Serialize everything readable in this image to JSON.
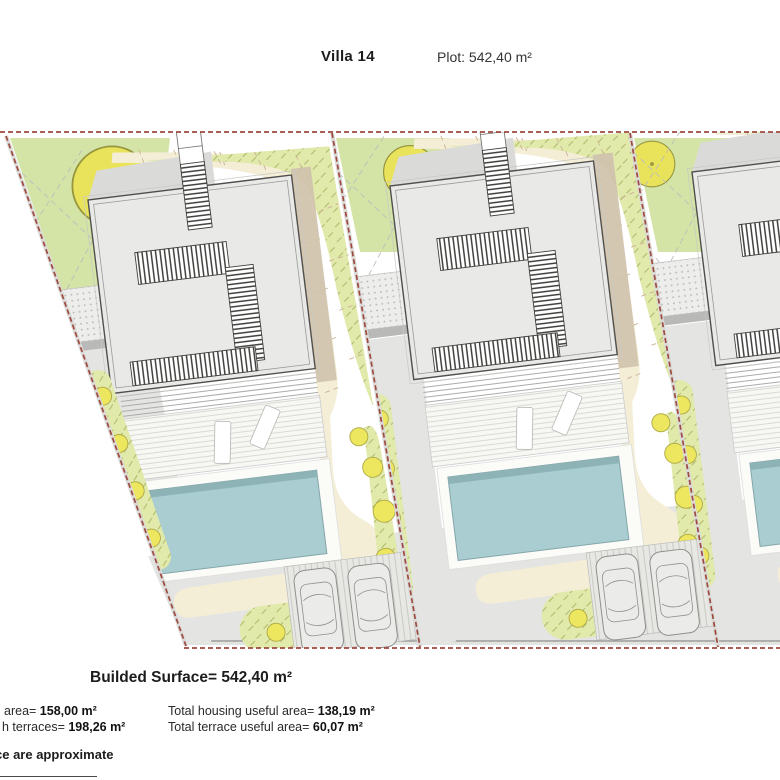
{
  "header": {
    "title": "Villa 14",
    "plot": "Plot: 542,40 m²"
  },
  "summary": {
    "builded_surface": "Builded Surface= 542,40 m²",
    "rows": [
      {
        "label": "area= ",
        "value": "158,00 m²"
      },
      {
        "label": "h terraces= ",
        "value": "198,26 m²"
      },
      {
        "label": "Total housing useful area= ",
        "value": "138,19 m²"
      },
      {
        "label": "Total terrace useful area= ",
        "value": "60,07 m²"
      }
    ],
    "footnote": "ce are approximate"
  },
  "plan": {
    "villas_visible": 3,
    "colors": {
      "boundary": "#9e4a3f",
      "patch": "#d3e4a6",
      "grass_bg": "#e1e9ab",
      "grass_tick": "#aab564",
      "bush": "#ece75f",
      "bush_stroke": "#afa945",
      "tree": "#e9e35c",
      "tree_stroke": "#97963f",
      "cream": "#f4eed7",
      "contour": "#c9b295",
      "shadow": "#cfc2ad",
      "roof": "#e9e9e7",
      "roof_stroke": "#4f4f4d",
      "inner_stroke": "#9a9a98",
      "ladder": "#3f3f3d",
      "deck_bg": "#f7f7f4",
      "deck_line": "#dadad4",
      "lounger": "#ffffff",
      "lounger_stroke": "#bcbcba",
      "pool": "#a9cdd0",
      "pool_edge": "#8db3b7",
      "pool_stroke": "#84a6aa",
      "gray": "#e4e4e2",
      "road_line": "#9b9b99",
      "dots_bg": "#ededeb",
      "dots": "#b4b4b2",
      "park_bg": "#e7e7e4",
      "park_line": "#c9c9c5",
      "car": "#ebebe9",
      "car_stroke": "#8f8f8d",
      "canopy": "#dadad8",
      "xline": "#bdbdbb",
      "wall": "#b9b9b7",
      "step": "#ababa9"
    }
  }
}
